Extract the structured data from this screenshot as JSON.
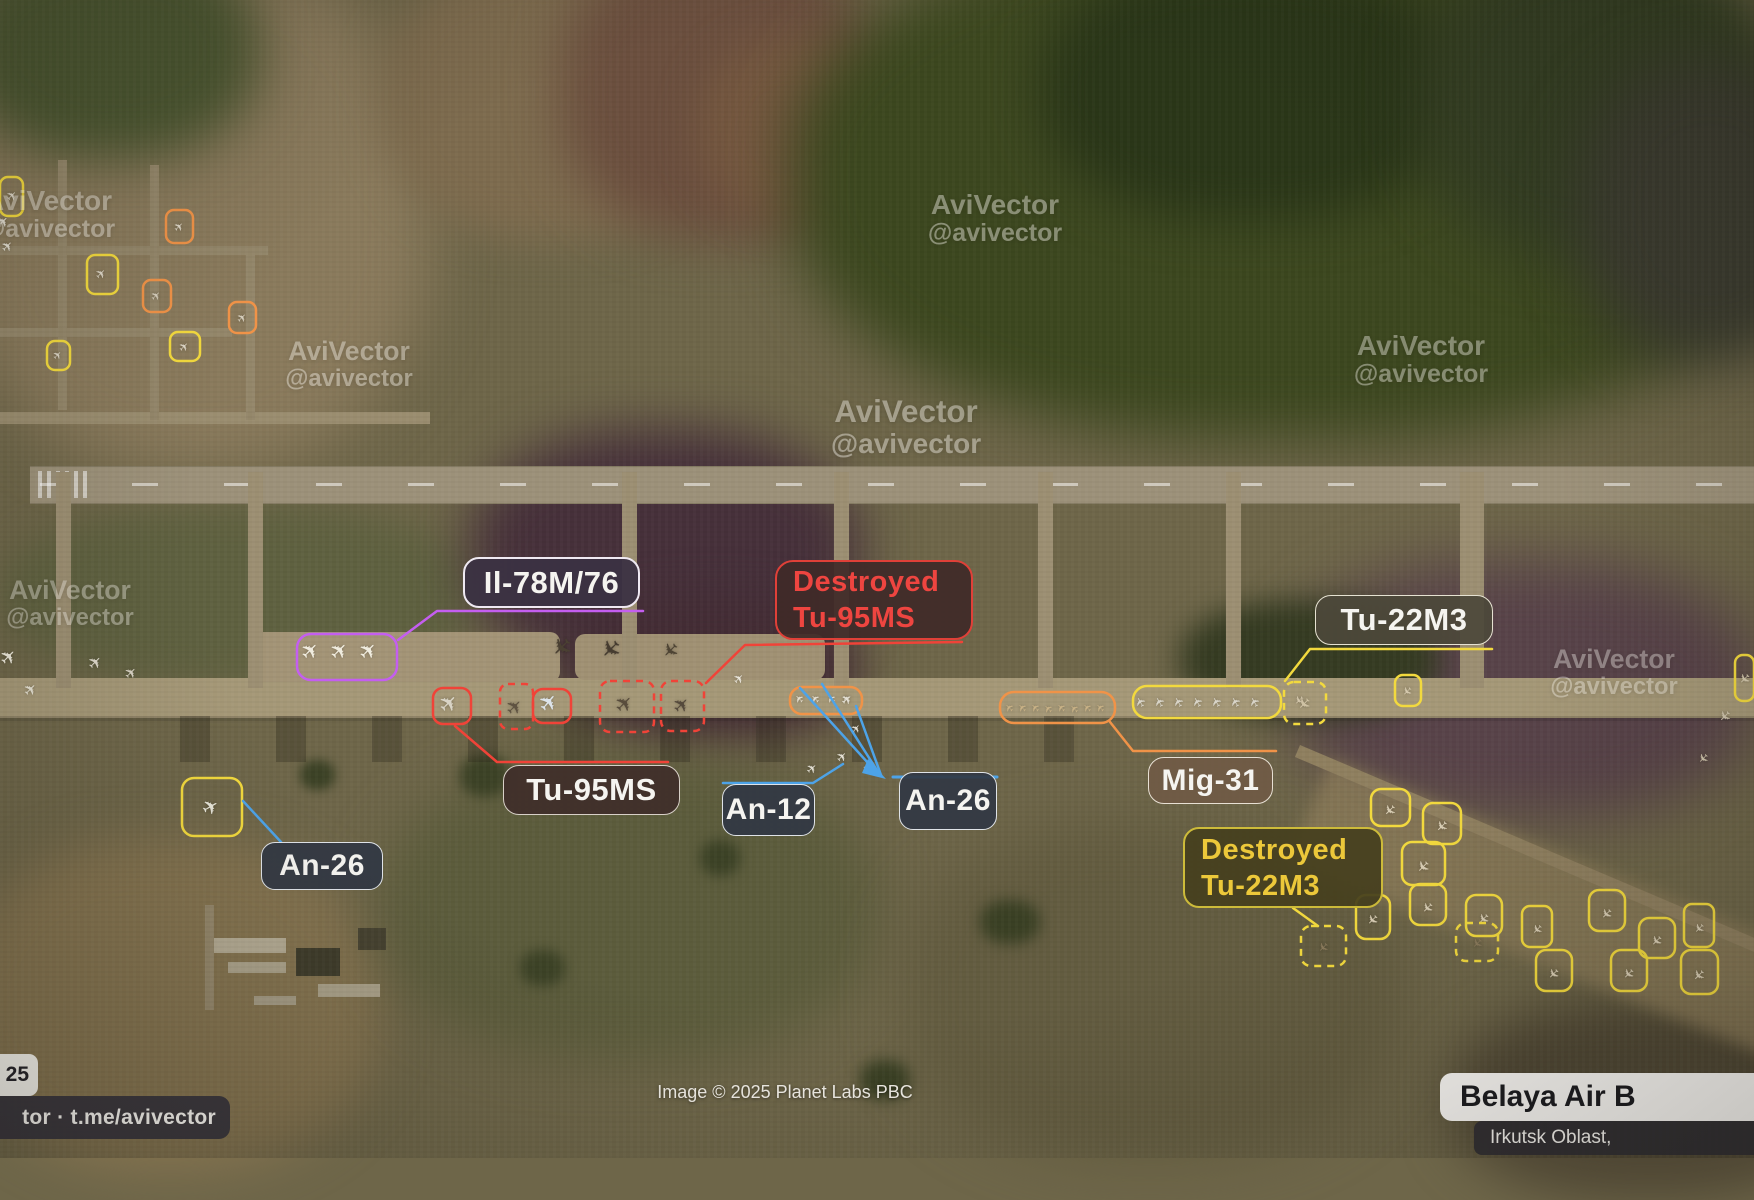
{
  "callouts": {
    "il78": {
      "text": "Il-78M/76"
    },
    "destroyed_tu95": {
      "line1": "Destroyed",
      "line2": "Tu-95MS"
    },
    "tu95": {
      "text": "Tu-95MS"
    },
    "an26_left": {
      "text": "An-26"
    },
    "an12": {
      "text": "An-12"
    },
    "an26_mid": {
      "text": "An-26"
    },
    "mig31": {
      "text": "Mig-31"
    },
    "tu22m3": {
      "text": "Tu-22M3"
    },
    "destroyed_tu22": {
      "line1": "Destroyed",
      "line2": "Tu-22M3"
    }
  },
  "watermark": {
    "line1": "AviVector",
    "line2": "@avivector"
  },
  "footer": {
    "date_fragment": "25",
    "channel": "tor · t.me/avivector",
    "attribution": "Image © 2025 Planet Labs PBC",
    "base_name": "Belaya Air B",
    "base_region": "Irkutsk Oblast,"
  },
  "colors": {
    "yellow": "#f2d93e",
    "orange": "#f09348",
    "red": "#f04338",
    "purple": "#c45ef0",
    "blue": "#4da3e8",
    "label_red_text": "#ee4540",
    "label_yellow_text": "#ecc83a"
  },
  "annotations": {
    "boxes": [
      {
        "x": 297,
        "y": 634,
        "w": 100,
        "h": 46,
        "c": "purple",
        "rx": 14
      },
      {
        "x": 433,
        "y": 688,
        "w": 38,
        "h": 36,
        "c": "red",
        "rx": 10
      },
      {
        "x": 533,
        "y": 689,
        "w": 38,
        "h": 34,
        "c": "red",
        "rx": 10
      },
      {
        "x": 500,
        "y": 684,
        "w": 33,
        "h": 45,
        "c": "red",
        "rx": 8,
        "dash": true
      },
      {
        "x": 600,
        "y": 681,
        "w": 54,
        "h": 51,
        "c": "red",
        "rx": 10,
        "dash": true
      },
      {
        "x": 661,
        "y": 681,
        "w": 43,
        "h": 50,
        "c": "red",
        "rx": 10,
        "dash": true
      },
      {
        "x": 790,
        "y": 687,
        "w": 72,
        "h": 27,
        "c": "orange",
        "rx": 12
      },
      {
        "x": 1000,
        "y": 692,
        "w": 115,
        "h": 31,
        "c": "orange",
        "rx": 14
      },
      {
        "x": 1133,
        "y": 686,
        "w": 148,
        "h": 32,
        "c": "yellow",
        "rx": 14
      },
      {
        "x": 1284,
        "y": 682,
        "w": 42,
        "h": 42,
        "c": "yellow",
        "rx": 10,
        "dash": true,
        "plane": [
          0,
          0,
          16,
          "#cfc2a4",
          135
        ]
      },
      {
        "x": 1395,
        "y": 675,
        "w": 26,
        "h": 31,
        "c": "yellow",
        "rx": 8,
        "plane": [
          0,
          0,
          12,
          "#d5c9ae",
          135
        ]
      },
      {
        "x": 1735,
        "y": 655,
        "w": 19,
        "h": 46,
        "c": "yellow",
        "rx": 8,
        "plane": [
          0,
          0,
          14,
          "#d5c9ae",
          135
        ]
      },
      {
        "x": 1371,
        "y": 789,
        "w": 39,
        "h": 37,
        "c": "yellow",
        "rx": 10,
        "plane": [
          0,
          2,
          15,
          "#d8cdb4",
          135
        ]
      },
      {
        "x": 1423,
        "y": 803,
        "w": 38,
        "h": 41,
        "c": "yellow",
        "rx": 10,
        "plane": [
          0,
          2,
          15,
          "#d8cdb4",
          135
        ]
      },
      {
        "x": 1402,
        "y": 842,
        "w": 43,
        "h": 43,
        "c": "yellow",
        "rx": 10,
        "plane": [
          0,
          2,
          16,
          "#d8cdb4",
          135
        ]
      },
      {
        "x": 1356,
        "y": 895,
        "w": 34,
        "h": 44,
        "c": "yellow",
        "rx": 10,
        "plane": [
          0,
          2,
          14,
          "#d8cdb4",
          135
        ]
      },
      {
        "x": 1410,
        "y": 884,
        "w": 36,
        "h": 41,
        "c": "yellow",
        "rx": 10,
        "plane": [
          0,
          2,
          14,
          "#d8cdb4",
          135
        ]
      },
      {
        "x": 1466,
        "y": 895,
        "w": 36,
        "h": 41,
        "c": "yellow",
        "rx": 10,
        "plane": [
          0,
          2,
          14,
          "#d8cdb4",
          135
        ]
      },
      {
        "x": 1522,
        "y": 906,
        "w": 30,
        "h": 41,
        "c": "yellow",
        "rx": 8,
        "plane": [
          0,
          2,
          13,
          "#d8cdb4",
          135
        ]
      },
      {
        "x": 1589,
        "y": 890,
        "w": 36,
        "h": 41,
        "c": "yellow",
        "rx": 10,
        "plane": [
          0,
          2,
          14,
          "#d8cdb4",
          135
        ]
      },
      {
        "x": 1639,
        "y": 918,
        "w": 36,
        "h": 40,
        "c": "yellow",
        "rx": 10,
        "plane": [
          0,
          2,
          14,
          "#d8cdb4",
          135
        ]
      },
      {
        "x": 1684,
        "y": 904,
        "w": 30,
        "h": 43,
        "c": "yellow",
        "rx": 8,
        "plane": [
          0,
          2,
          13,
          "#d8cdb4",
          135
        ]
      },
      {
        "x": 1536,
        "y": 950,
        "w": 36,
        "h": 41,
        "c": "yellow",
        "rx": 10,
        "plane": [
          0,
          2,
          14,
          "#d8cdb4",
          135
        ]
      },
      {
        "x": 1611,
        "y": 950,
        "w": 36,
        "h": 41,
        "c": "yellow",
        "rx": 10,
        "plane": [
          0,
          2,
          14,
          "#d8cdb4",
          135
        ]
      },
      {
        "x": 1681,
        "y": 950,
        "w": 37,
        "h": 44,
        "c": "yellow",
        "rx": 10,
        "plane": [
          0,
          2,
          15,
          "#d8cdb4",
          135
        ]
      },
      {
        "x": 1456,
        "y": 923,
        "w": 42,
        "h": 38,
        "c": "yellow",
        "rx": 10,
        "dash": true,
        "plane": [
          0,
          0,
          13,
          "#8a7a5c",
          135
        ]
      },
      {
        "x": 1301,
        "y": 926,
        "w": 45,
        "h": 40,
        "c": "yellow",
        "rx": 10,
        "dash": true,
        "plane": [
          0,
          0,
          13,
          "#8a7a5c",
          135
        ]
      },
      {
        "x": 182,
        "y": 778,
        "w": 60,
        "h": 58,
        "c": "yellow",
        "rx": 12,
        "plane": [
          0,
          0,
          20,
          "#e8e6da",
          -30
        ]
      },
      {
        "x": 0,
        "y": 177,
        "w": 23,
        "h": 39,
        "c": "yellow",
        "rx": 8,
        "plane": [
          2,
          0,
          13,
          "#ddd6c6",
          -45
        ]
      },
      {
        "x": 166,
        "y": 210,
        "w": 27,
        "h": 33,
        "c": "orange",
        "rx": 8,
        "plane": [
          0,
          0,
          12,
          "#ddd6c6",
          -45
        ]
      },
      {
        "x": 87,
        "y": 255,
        "w": 31,
        "h": 39,
        "c": "yellow",
        "rx": 8,
        "plane": [
          0,
          0,
          13,
          "#ddd6c6",
          -45
        ]
      },
      {
        "x": 143,
        "y": 280,
        "w": 28,
        "h": 32,
        "c": "orange",
        "rx": 8,
        "plane": [
          0,
          0,
          12,
          "#d6cebc",
          -45
        ]
      },
      {
        "x": 229,
        "y": 302,
        "w": 27,
        "h": 31,
        "c": "orange",
        "rx": 8,
        "plane": [
          0,
          0,
          12,
          "#d6cebc",
          -45
        ]
      },
      {
        "x": 47,
        "y": 341,
        "w": 23,
        "h": 29,
        "c": "yellow",
        "rx": 8,
        "plane": [
          0,
          0,
          11,
          "#ddd6c6",
          -45
        ]
      },
      {
        "x": 170,
        "y": 332,
        "w": 30,
        "h": 29,
        "c": "yellow",
        "rx": 8,
        "plane": [
          0,
          0,
          12,
          "#ddd6c6",
          -45
        ]
      }
    ],
    "lines": [
      {
        "c": "purple",
        "w": 2.5,
        "pts": [
          [
            643,
            611
          ],
          [
            437,
            611
          ],
          [
            398,
            640
          ]
        ]
      },
      {
        "c": "red",
        "w": 2.5,
        "pts": [
          [
            962,
            642
          ],
          [
            745,
            645
          ],
          [
            706,
            683
          ]
        ]
      },
      {
        "c": "red",
        "w": 2.5,
        "pts": [
          [
            455,
            726
          ],
          [
            497,
            762
          ],
          [
            668,
            762
          ]
        ]
      },
      {
        "c": "blue",
        "w": 2.5,
        "pts": [
          [
            723,
            783
          ],
          [
            813,
            783
          ],
          [
            843,
            764
          ]
        ]
      },
      {
        "c": "blue",
        "w": 3,
        "pts": [
          [
            893,
            777
          ],
          [
            997,
            777
          ]
        ]
      },
      {
        "c": "blue",
        "w": 2.5,
        "pts": [
          [
            800,
            688
          ],
          [
            878,
            774
          ]
        ]
      },
      {
        "c": "blue",
        "w": 2.5,
        "pts": [
          [
            822,
            684
          ],
          [
            880,
            775
          ]
        ]
      },
      {
        "c": "blue",
        "w": 2.5,
        "pts": [
          [
            856,
            706
          ],
          [
            881,
            775
          ]
        ]
      },
      {
        "c": "blue",
        "w": 2.5,
        "pts": [
          [
            243,
            801
          ],
          [
            281,
            842
          ]
        ]
      },
      {
        "c": "orange",
        "w": 2.5,
        "pts": [
          [
            1110,
            722
          ],
          [
            1133,
            751
          ],
          [
            1276,
            751
          ]
        ]
      },
      {
        "c": "yellow",
        "w": 2.5,
        "pts": [
          [
            1492,
            649
          ],
          [
            1310,
            649
          ],
          [
            1285,
            681
          ]
        ]
      },
      {
        "c": "yellow",
        "w": 2.5,
        "pts": [
          [
            1293,
            908
          ],
          [
            1318,
            926
          ]
        ]
      }
    ],
    "arrow": {
      "c": "blue",
      "pts": [
        [
          886,
          779
        ],
        [
          868,
          759
        ],
        [
          862,
          773
        ]
      ]
    },
    "planes": [
      [
        10,
        657,
        20,
        "#ece8da",
        -45
      ],
      [
        32,
        690,
        16,
        "#e6e2d4",
        -45
      ],
      [
        97,
        663,
        17,
        "#ddd8ca",
        -45
      ],
      [
        132,
        673,
        15,
        "#d8d2c4",
        -45
      ],
      [
        4,
        222,
        15,
        "#e2ddd0",
        -45
      ],
      [
        9,
        247,
        14,
        "#e2ddd0",
        -45
      ],
      [
        740,
        679,
        13,
        "#e8e4da",
        -45
      ],
      [
        313,
        652,
        22,
        "#f0ecdf",
        -45
      ],
      [
        342,
        652,
        22,
        "#f0ecdf",
        -45
      ],
      [
        371,
        652,
        22,
        "#f0ecdf",
        -45
      ],
      [
        451,
        704,
        23,
        "#d9d4c6",
        -45
      ],
      [
        551,
        703,
        23,
        "#dde4ea",
        -50
      ],
      [
        516,
        707,
        20,
        "#5f5342",
        -45
      ],
      [
        627,
        705,
        22,
        "#584c3c",
        -45
      ],
      [
        683,
        705,
        20,
        "#554a3c",
        -45
      ],
      [
        563,
        646,
        25,
        "#4a4032",
        135
      ],
      [
        612,
        648,
        25,
        "#463c30",
        135
      ],
      [
        672,
        650,
        20,
        "#4e4434",
        135
      ],
      [
        800,
        698,
        11,
        "#e6e0d2",
        -135
      ],
      [
        816,
        698,
        11,
        "#e6e0d2",
        -135
      ],
      [
        832,
        698,
        11,
        "#e6e0d2",
        -135
      ],
      [
        847,
        698,
        11,
        "#e6e0d2",
        -135
      ],
      [
        1010,
        707,
        11,
        "#c9b286",
        -135
      ],
      [
        1023,
        707,
        11,
        "#c9b286",
        -135
      ],
      [
        1036,
        707,
        11,
        "#c9b286",
        -135
      ],
      [
        1049,
        708,
        11,
        "#c9b286",
        -135
      ],
      [
        1062,
        707,
        11,
        "#c9b286",
        -135
      ],
      [
        1075,
        708,
        11,
        "#c9b286",
        -135
      ],
      [
        1088,
        707,
        11,
        "#c9b286",
        -135
      ],
      [
        1101,
        707,
        11,
        "#c9b286",
        -135
      ],
      [
        1142,
        701,
        13,
        "#d8d4c8",
        -120
      ],
      [
        1161,
        701,
        13,
        "#d8d4c8",
        -120
      ],
      [
        1180,
        701,
        13,
        "#d8d4c8",
        -120
      ],
      [
        1199,
        701,
        13,
        "#d8d4c8",
        -120
      ],
      [
        1218,
        701,
        13,
        "#d8d4c8",
        -120
      ],
      [
        1237,
        701,
        13,
        "#d8d4c8",
        -120
      ],
      [
        1256,
        701,
        13,
        "#d8d4c8",
        -120
      ],
      [
        848,
        700,
        13,
        "#e4e0d4",
        -40
      ],
      [
        857,
        729,
        12,
        "#e0dcd0",
        -50
      ],
      [
        843,
        757,
        13,
        "#e4e0d4",
        -45
      ],
      [
        813,
        769,
        13,
        "#e0dcd0",
        -40
      ],
      [
        869,
        769,
        12,
        "#dcd8cc",
        -50
      ],
      [
        1300,
        700,
        12,
        "#d6c9ae",
        135
      ],
      [
        1725,
        715,
        15,
        "#cfc4ac",
        135
      ],
      [
        1703,
        757,
        13,
        "#cfc4ac",
        135
      ]
    ],
    "watermarks": [
      {
        "cx": 48,
        "ty": 186,
        "s": 1,
        "op": 0.42
      },
      {
        "cx": 995,
        "ty": 190,
        "s": 1,
        "op": 0.42
      },
      {
        "cx": 349,
        "ty": 337,
        "s": 0.95,
        "op": 0.4
      },
      {
        "cx": 906,
        "ty": 395,
        "s": 1.12,
        "op": 0.42
      },
      {
        "cx": 1421,
        "ty": 331,
        "s": 1,
        "op": 0.4
      },
      {
        "cx": 1614,
        "ty": 645,
        "s": 0.95,
        "op": 0.38
      },
      {
        "cx": 70,
        "ty": 576,
        "s": 0.95,
        "op": 0.38
      }
    ]
  }
}
